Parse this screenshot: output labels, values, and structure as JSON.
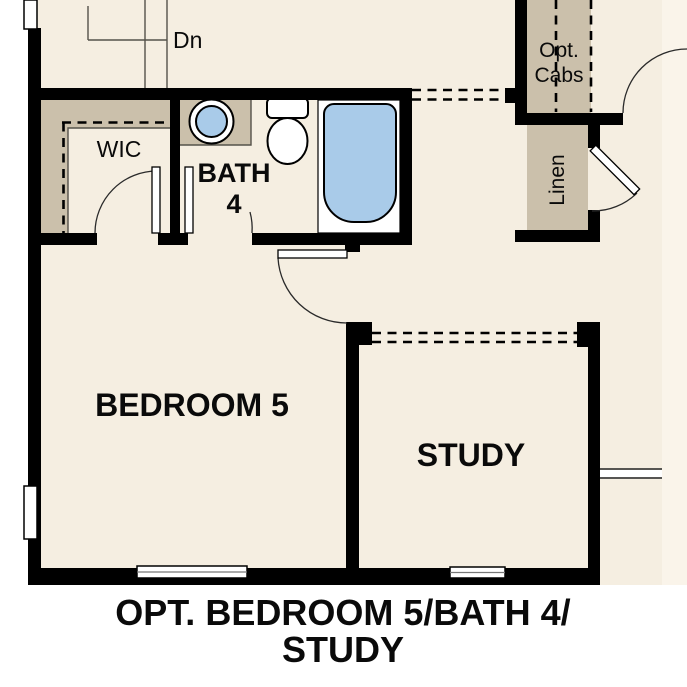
{
  "plan": {
    "caption": {
      "line1": "OPT. BEDROOM 5/BATH 4/",
      "line2": "STUDY"
    },
    "rooms": {
      "bedroom5": "BEDROOM 5",
      "study": "STUDY",
      "bath_line1": "BATH",
      "bath_line2": "4",
      "wic": "WIC",
      "linen": "Linen",
      "opt_cabs_line1": "Opt.",
      "opt_cabs_line2": "Cabs",
      "stairs_down": "Dn"
    },
    "colors": {
      "wall": "#000000",
      "floor": "#f5eee1",
      "closet_tan": "#cbc0ab",
      "fixture_blue": "#a9cbe9",
      "page": "#ffffff"
    }
  }
}
